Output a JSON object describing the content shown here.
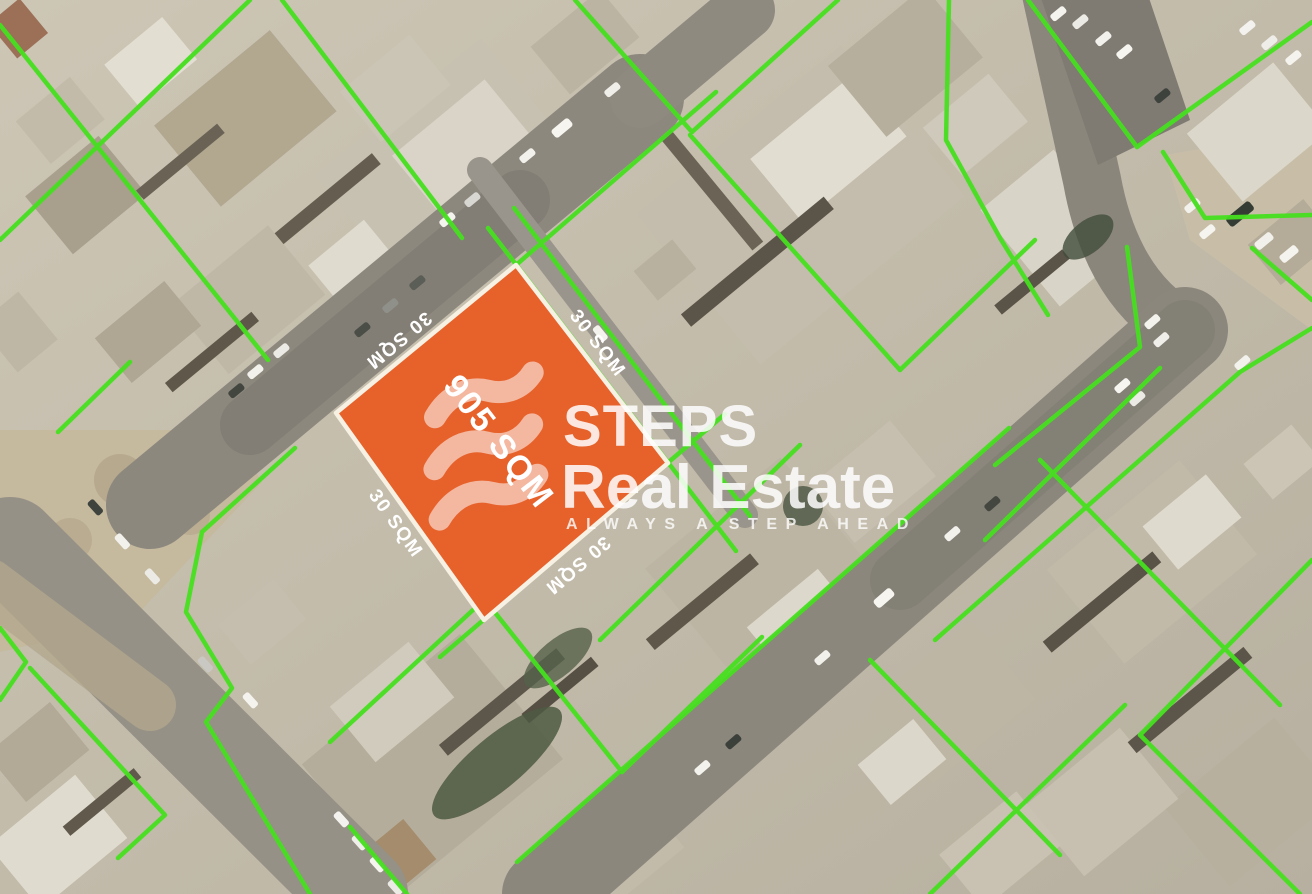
{
  "map": {
    "type": "satellite-cadastral-listing",
    "highlighted_plot": {
      "area_label": "905 SQM",
      "edge_labels": {
        "top_left": "30 SQM",
        "top_right": "30 SQM",
        "bottom_left": "30 SQM",
        "bottom_right": "30 SQM"
      }
    },
    "colors": {
      "plot_fill": "#E7612B",
      "plot_border": "#F7F1E4",
      "parcel_line": "#46E01F"
    }
  },
  "watermark": {
    "logo_icon": "steps-logo-icon",
    "brand_line1": "STEPS",
    "brand_line2": "Real Estate",
    "tagline": "ALWAYS A STEP AHEAD",
    "color": "#FFFFFF"
  }
}
